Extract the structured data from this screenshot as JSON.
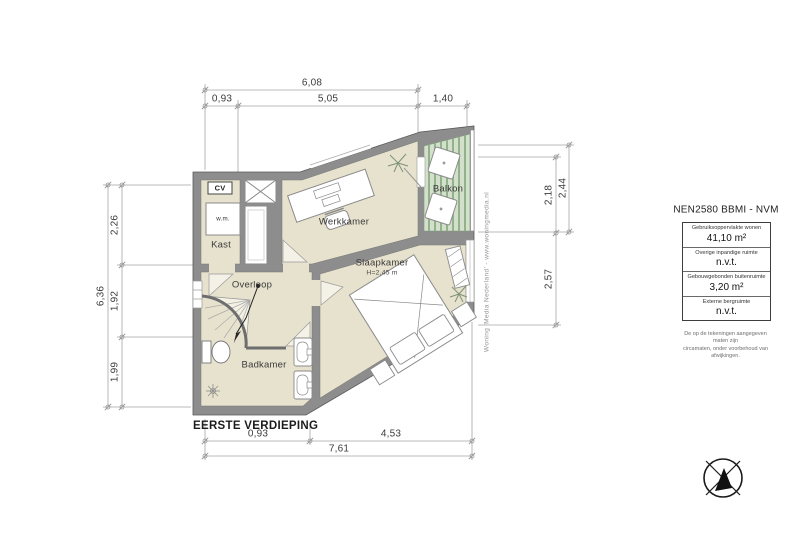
{
  "plan": {
    "floor_label": "EERSTE VERDIEPING",
    "watermark": "Woning 'Media Nederland' - www.woningmedia.nl",
    "rooms": {
      "werkkamer": "Werkkamer",
      "balkon": "Balkon",
      "slaapkamer": "Slaapkamer",
      "slaapkamer_height": "H=2,45 m",
      "overloop": "Overloop",
      "badkamer": "Badkamer",
      "kast": "Kast",
      "cv": "CV",
      "wm": "w.m."
    },
    "dimensions": {
      "top": {
        "total": "6,08",
        "seg1": "0,93",
        "seg2": "5,05",
        "seg3": "1,40"
      },
      "left": {
        "total": "6,36",
        "seg1": "2,26",
        "seg2": "1,92",
        "seg3": "1,99"
      },
      "right": {
        "outer": "2,44",
        "seg1": "2,18",
        "seg2": "2,57"
      },
      "bottom": {
        "total": "7,61",
        "seg1": "0,93",
        "seg2": "4,53"
      }
    }
  },
  "legend": {
    "title": "NEN2580 BBMI - NVM",
    "rows": [
      {
        "label": "Gebruiksoppervlakte wonen",
        "value": "41,10 m²"
      },
      {
        "label": "Overige inpandige ruimte",
        "value": "n.v.t."
      },
      {
        "label": "Gebouwgebonden buitenruimte",
        "value": "3,20 m²"
      },
      {
        "label": "Externe bergruimte",
        "value": "n.v.t."
      }
    ],
    "disclaimer": [
      "De op de tekeningen aangegeven maten zijn",
      "circamaten, onder voorbehoud van afwijkingen."
    ]
  },
  "colors": {
    "floor": "#e7e2cd",
    "wall": "#8d8d8d",
    "balcony_floor": "#d3e0cb",
    "balcony_stripe": "#93b28c",
    "dimension_line": "#9a9a9a",
    "text": "#3c3c3c"
  }
}
